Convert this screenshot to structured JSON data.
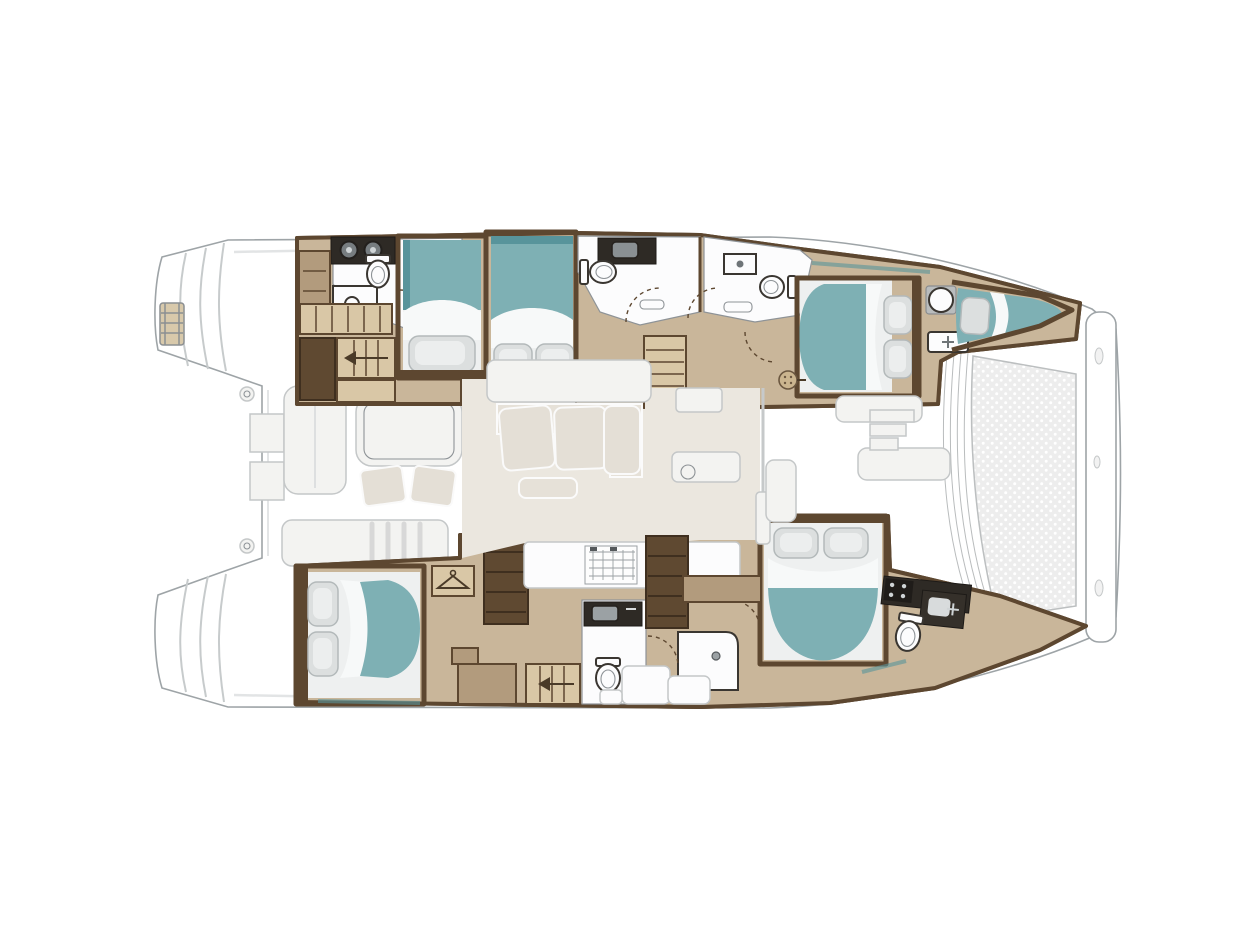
{
  "meta": {
    "title": "Catamaran yacht interior floor plan, overhead view, bow facing right"
  },
  "colors": {
    "deck": "#ffffff",
    "deckLine": "#9ea4a7",
    "deckShadow": "#e2e4e5",
    "hullFrame": "#5d4730",
    "woodLight": "#c9b69a",
    "woodMid": "#b29b7d",
    "woodDark": "#5f4931",
    "counterDark": "#2e2a25",
    "white": "#fcfcfd",
    "fixtureDark": "#3a3631",
    "fixtureLine": "#8e9397",
    "teal": "#7eb0b4",
    "tealDark": "#58949b",
    "sheet": "#f7f9f9",
    "pillow": "#dcdfdf",
    "pillowEdge": "#b3b9ba",
    "salonFloor": "#ebe7df",
    "furniture": "#e6e1d8",
    "furnitureStroke": "#c4c7c8",
    "cockpitSeat": "#f3f3f1",
    "stair": "#d9c7a6",
    "tramp": "#ededed",
    "trampLine": "#bcbfc0"
  },
  "vessel": {
    "type": "catamaran",
    "orientation": {
      "bow": "right",
      "stern": "left"
    },
    "exterior_areas": [
      "stern-swim-steps",
      "boarding-ladder",
      "aft-cockpit",
      "forward-cockpit",
      "bow-trampoline",
      "forward-crossbeam"
    ],
    "hulls": [
      {
        "id": "port-hull",
        "position": "top",
        "rooms": [
          {
            "name": "aft-head",
            "fixtures": [
              "twin-sink-counter",
              "toilet",
              "vanity",
              "cabinet",
              "wardrobe",
              "companionway-stairs"
            ]
          },
          {
            "name": "aft-cabin",
            "beds": [
              "single-berth",
              "double-berth"
            ]
          },
          {
            "name": "mid-head-forward-left",
            "fixtures": [
              "sink-counter",
              "toilet"
            ]
          },
          {
            "name": "mid-head-forward-right",
            "fixtures": [
              "sink",
              "toilet",
              "bench"
            ]
          },
          {
            "name": "forward-cabin",
            "beds": [
              "double-berth"
            ],
            "fixtures": [
              "shower-rose",
              "round-sink",
              "washbasin-unit"
            ]
          },
          {
            "name": "bow-berth",
            "beds": [
              "single-berth"
            ]
          }
        ]
      },
      {
        "id": "starboard-hull",
        "position": "bottom",
        "rooms": [
          {
            "name": "aft-cabin",
            "beds": [
              "double-berth"
            ],
            "fixtures": [
              "wardrobe-hanger",
              "shelving",
              "desk",
              "companionway-stairs"
            ]
          },
          {
            "name": "mid-head",
            "fixtures": [
              "sink-counter",
              "toilet",
              "shower-stall"
            ]
          },
          {
            "name": "galley-lower",
            "fixtures": [
              "counters"
            ]
          },
          {
            "name": "forward-cabin",
            "beds": [
              "double-berth"
            ]
          },
          {
            "name": "bow-head",
            "fixtures": [
              "stove-counter",
              "sink-unit",
              "toilet"
            ]
          }
        ]
      }
    ],
    "salon": {
      "furniture": [
        "sideboard",
        "l-shaped-sofa",
        "chaise",
        "ottoman",
        "galley-island",
        "stove-grid",
        "shelf-column",
        "nav-counter",
        "deck-hatch"
      ]
    },
    "aft_cockpit": {
      "furniture": [
        "side-bench",
        "dining-table",
        "chair",
        "chair",
        "transom-bench",
        "winch",
        "winch",
        "locker",
        "locker"
      ]
    },
    "forward_cockpit": {
      "furniture": [
        "bench-seat",
        "bench-seat",
        "side-seat",
        "step-shelves"
      ]
    },
    "counts": {
      "beds": 6,
      "toilets": 5,
      "showers": 2
    }
  }
}
